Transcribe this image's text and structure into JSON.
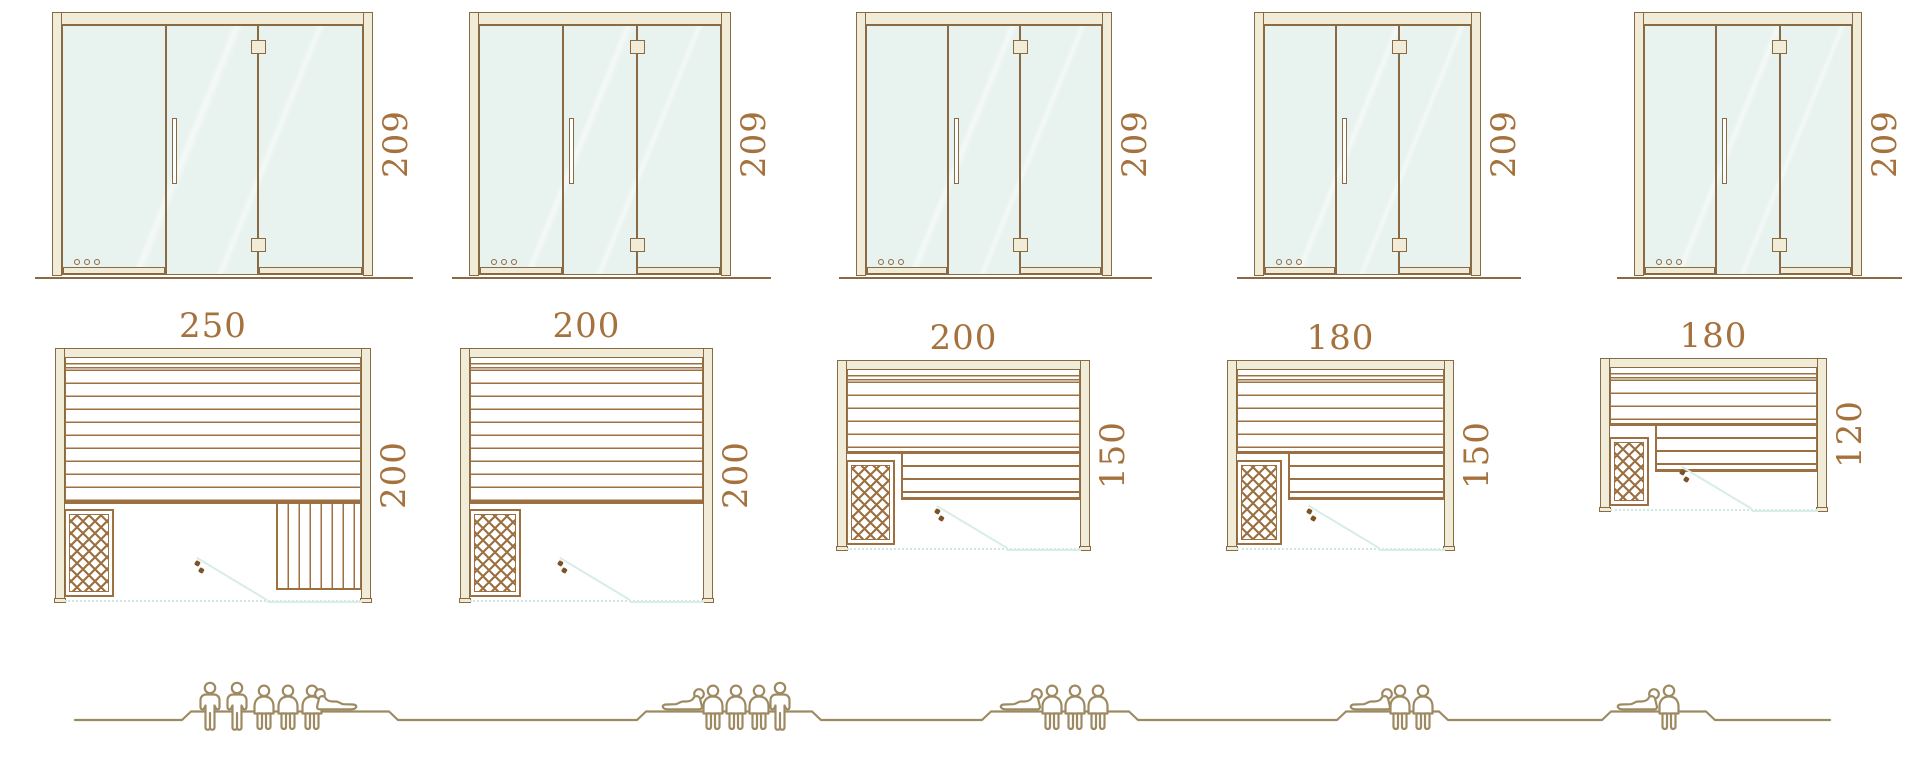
{
  "colors": {
    "outline": "#8a6a42",
    "slat": "#9c7040",
    "cream": "#f1ecd8",
    "glass": "#e8f2ef",
    "dim_text": "#a5713c",
    "people": "#9e8a62",
    "swing_line": "#d8ece8",
    "opening_dots": "#cfe6e1",
    "handle_dots": "#7d5226"
  },
  "units": [
    {
      "id": "sauna-250x200",
      "door_height_label": "209",
      "width_label": "250",
      "depth_label": "200",
      "width_cm": 250,
      "depth_cm": 200,
      "figures": [
        "standing",
        "standing",
        "sitting",
        "sitting",
        "sitting",
        "lying"
      ]
    },
    {
      "id": "sauna-200x200",
      "door_height_label": "209",
      "width_label": "200",
      "depth_label": "200",
      "width_cm": 200,
      "depth_cm": 200,
      "figures": [
        "lying",
        "sitting",
        "sitting",
        "sitting",
        "standing"
      ]
    },
    {
      "id": "sauna-200x150",
      "door_height_label": "209",
      "width_label": "200",
      "depth_label": "150",
      "width_cm": 200,
      "depth_cm": 150,
      "figures": [
        "lying",
        "sitting",
        "sitting",
        "sitting"
      ]
    },
    {
      "id": "sauna-180x150",
      "door_height_label": "209",
      "width_label": "180",
      "depth_label": "150",
      "width_cm": 180,
      "depth_cm": 150,
      "figures": [
        "lying",
        "sitting",
        "sitting"
      ]
    },
    {
      "id": "sauna-180x120",
      "door_height_label": "209",
      "width_label": "180",
      "depth_label": "120",
      "width_cm": 180,
      "depth_cm": 120,
      "figures": [
        "lying",
        "sitting"
      ]
    }
  ]
}
